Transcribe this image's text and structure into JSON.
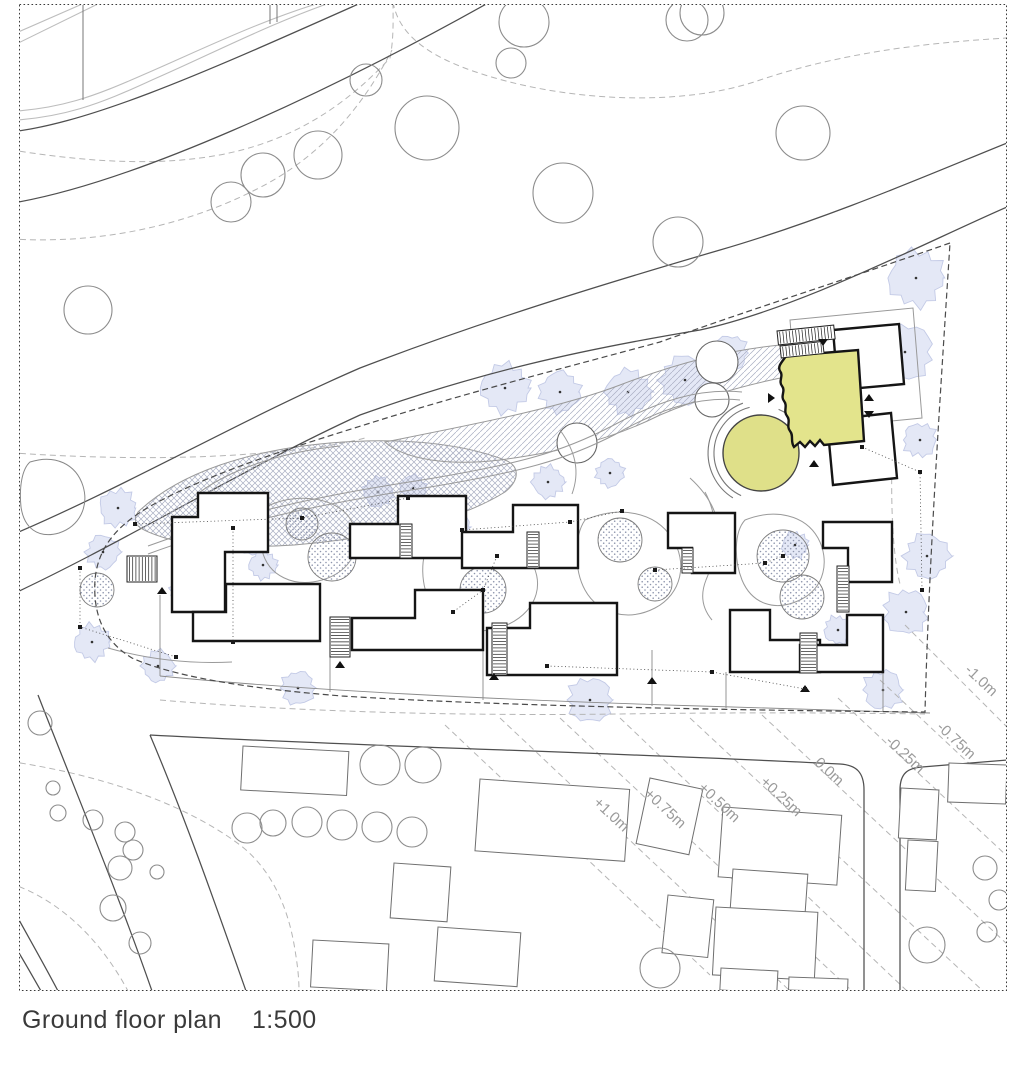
{
  "caption": {
    "title": "Ground floor plan",
    "scale": "1:500"
  },
  "colors": {
    "paper": "#ffffff",
    "line_dark": "#4f4f4f",
    "line_light": "#bdbdbd",
    "contour": "#b5b5b5",
    "boundary": "#4a4a4a",
    "path": "#9a9a9a",
    "building_stroke": "#151515",
    "neighbor_stroke": "#6f6f6f",
    "tree_stroke": "#8c8c8c",
    "canopy_fill": "#e4e8f6",
    "canopy_edge": "#c3cae6",
    "hatch_line": "#a9aec2",
    "dot_fill": "#8f96ad",
    "highlight_fill": "#e3e48c",
    "highlight_circle_fill": "#dfe089",
    "label_color": "#9a9a9a",
    "frame": "#3a3a3a"
  },
  "contour_labels": [
    {
      "text": "+1.0m",
      "x": 608,
      "y": 818,
      "rot": 43
    },
    {
      "text": "+0.75m",
      "x": 662,
      "y": 812,
      "rot": 43
    },
    {
      "text": "+0.50m",
      "x": 716,
      "y": 806,
      "rot": 43
    },
    {
      "text": "+0.25m",
      "x": 778,
      "y": 800,
      "rot": 43
    },
    {
      "text": "0.0m",
      "x": 826,
      "y": 775,
      "rot": 43
    },
    {
      "text": "-0.25m",
      "x": 902,
      "y": 758,
      "rot": 43
    },
    {
      "text": "-0.75m",
      "x": 953,
      "y": 744,
      "rot": 43
    },
    {
      "text": "-1.0m",
      "x": 978,
      "y": 684,
      "rot": 43
    }
  ],
  "roads": {
    "light": [
      "M0,112 C60,110 95,96 145,74 C205,48 265,18 336,-2",
      "M0,121 C62,119 100,104 152,80 C212,54 272,22 344,-2",
      "M0,40 L96,-2",
      "M0,52 L110,-2"
    ],
    "dark": [
      "M0,133 C85,127 210,70 372,-2",
      "M0,205 C125,188 330,92 497,-2",
      "M0,540 C120,490 240,420 360,368 C480,322 600,285 720,250 C830,218 935,172 1007,143",
      "M0,600 C120,545 240,470 360,415 C480,372 580,350 700,330 C800,308 920,245 1007,207",
      "M38,695 C75,790 116,888 152,991",
      "M150,735 C186,820 216,906 246,991",
      "M150,735 C350,746 600,752 840,764 C856,765 864,772 864,790 L864,991",
      "M900,991 L900,790 C900,773 908,768 922,767 L1007,760",
      "M8,900 C30,940 45,966 58,991",
      "M0,922 C18,950 30,972 41,991"
    ],
    "posts": [
      [
        83,
        2,
        83,
        100
      ],
      [
        270,
        2,
        270,
        24
      ],
      [
        277,
        2,
        277,
        22
      ]
    ]
  },
  "contours": {
    "wavy": [
      "M0,148 C70,160 140,166 200,158 C280,148 340,112 390,58 C394,38 393,18 393,0",
      "M0,238 C90,246 180,228 255,190 C320,158 362,108 392,50",
      "M393,2 C398,30 420,52 470,70 C560,102 680,108 760,80 C850,50 940,42 1007,38",
      "M0,452 C80,458 170,460 250,454 C300,450 335,446 365,438",
      "M0,760 C90,772 180,800 240,845 C270,868 288,905 295,950 C298,968 299,980 299,991",
      "M0,880 C50,894 95,930 128,991",
      "M160,700 C300,712 460,716 620,714 C760,712 850,713 925,714",
      "M893,428 C890,495 892,552 900,584"
    ],
    "diagonal": [
      [
        445,
        725,
        710,
        975
      ],
      [
        500,
        718,
        790,
        991
      ],
      [
        560,
        718,
        852,
        991
      ],
      [
        620,
        718,
        907,
        991
      ],
      [
        690,
        718,
        983,
        991
      ],
      [
        762,
        715,
        1007,
        944
      ],
      [
        838,
        698,
        1007,
        856
      ],
      [
        880,
        680,
        1007,
        799
      ],
      [
        905,
        625,
        1007,
        727
      ]
    ]
  },
  "boundary_d": "M950,243 C850,278 755,308 660,342 C575,365 470,392 380,420 C300,445 218,470 158,502 C120,522 98,545 95,580 C93,612 102,640 132,658 C172,676 242,688 342,696 C482,705 700,710 925,712 C929,560 940,400 950,243 Z",
  "pond_d": "M30,462 C55,454 76,464 83,486 C89,506 80,526 59,533 C38,539 24,528 21,507 C19,487 22,469 30,462 Z",
  "hatch": {
    "cross_d": "M138,512 C180,472 250,450 330,443 C400,437 460,443 505,460 C520,466 520,480 505,492 C460,520 400,532 340,540 C270,550 200,548 165,538 C140,530 130,525 138,512 Z",
    "single_d": "M385,442 C470,425 560,408 620,385 C680,362 730,350 780,345 C800,343 815,345 818,355 C820,365 810,372 790,376 C740,386 700,398 660,415 C610,440 560,452 500,460 C450,466 405,460 385,442 Z"
  },
  "paths_light": [
    "M148,546 C240,512 330,494 422,480 C520,464 562,452 612,426 C660,400 700,388 742,392",
    "M148,554 C240,520 332,502 424,488 C522,472 566,460 616,434 C662,408 700,396 740,400",
    "M270,505 C300,492 340,498 352,522 C364,548 350,572 322,580 C294,588 268,576 262,550 C258,528 260,515 270,505 Z",
    "M430,542 C468,527 508,532 528,557 C546,581 538,610 509,624 C478,638 446,630 432,606 C420,585 420,557 430,542 Z",
    "M585,520 C620,505 655,512 672,538 C688,562 682,594 655,608 C628,622 598,614 585,590 C574,570 574,536 585,520 Z",
    "M745,520 C775,508 805,515 818,538 C830,560 825,588 800,600 C775,612 752,604 742,580 C734,560 734,532 745,520 Z",
    "M690,478 C712,498 722,520 719,546",
    "M200,492 C230,470 280,452 340,446",
    "M108,648 C150,660 192,664 232,662",
    "M560,430 C576,452 580,472 572,494",
    "M705,492 C720,520 718,552 706,580 C700,595 702,608 712,620"
  ],
  "plaza_arcs": [
    {
      "cx": 761,
      "cy": 453,
      "r": 47,
      "a1": 115,
      "a2": 256
    },
    {
      "cx": 761,
      "cy": 453,
      "r": 53,
      "a1": 122,
      "a2": 250
    },
    {
      "cx": 761,
      "cy": 453,
      "r": 47,
      "a1": 292,
      "a2": 344
    }
  ],
  "planting": [
    [
      302,
      524,
      16
    ],
    [
      332,
      557,
      24
    ],
    [
      97,
      590,
      17
    ],
    [
      483,
      590,
      23
    ],
    [
      500,
      550,
      15
    ],
    [
      620,
      540,
      22
    ],
    [
      655,
      584,
      17
    ],
    [
      453,
      613,
      22
    ],
    [
      783,
      556,
      26
    ],
    [
      802,
      597,
      22
    ]
  ],
  "canopies": [
    [
      505,
      388,
      26
    ],
    [
      560,
      392,
      22
    ],
    [
      628,
      392,
      24
    ],
    [
      685,
      380,
      26
    ],
    [
      730,
      353,
      19
    ],
    [
      905,
      352,
      30
    ],
    [
      916,
      278,
      30
    ],
    [
      920,
      440,
      18
    ],
    [
      927,
      556,
      24
    ],
    [
      906,
      612,
      24
    ],
    [
      883,
      690,
      21
    ],
    [
      118,
      508,
      20
    ],
    [
      103,
      552,
      18
    ],
    [
      92,
      642,
      19
    ],
    [
      158,
      666,
      17
    ],
    [
      250,
      540,
      16
    ],
    [
      263,
      565,
      15
    ],
    [
      298,
      688,
      18
    ],
    [
      590,
      700,
      24
    ],
    [
      452,
      527,
      20
    ],
    [
      520,
      548,
      18
    ],
    [
      548,
      482,
      17
    ],
    [
      610,
      473,
      15
    ],
    [
      795,
      545,
      14
    ],
    [
      183,
      592,
      14
    ],
    [
      378,
      492,
      16
    ],
    [
      413,
      488,
      14
    ],
    [
      838,
      630,
      15
    ]
  ],
  "trees": [
    [
      366,
      80,
      16
    ],
    [
      427,
      128,
      32
    ],
    [
      524,
      22,
      25
    ],
    [
      511,
      63,
      15
    ],
    [
      563,
      193,
      30
    ],
    [
      318,
      155,
      24
    ],
    [
      231,
      202,
      20
    ],
    [
      263,
      175,
      22
    ],
    [
      687,
      20,
      21
    ],
    [
      678,
      242,
      25
    ],
    [
      702,
      13,
      22
    ],
    [
      803,
      133,
      27
    ],
    [
      88,
      310,
      24
    ],
    [
      40,
      723,
      12
    ],
    [
      53,
      788,
      7
    ],
    [
      58,
      813,
      8
    ],
    [
      93,
      820,
      10
    ],
    [
      125,
      832,
      10
    ],
    [
      133,
      850,
      10
    ],
    [
      120,
      868,
      12
    ],
    [
      157,
      872,
      7
    ],
    [
      113,
      908,
      13
    ],
    [
      140,
      943,
      11
    ],
    [
      247,
      828,
      15
    ],
    [
      273,
      823,
      13
    ],
    [
      307,
      822,
      15
    ],
    [
      342,
      825,
      15
    ],
    [
      377,
      827,
      15
    ],
    [
      412,
      832,
      15
    ],
    [
      380,
      765,
      20
    ],
    [
      423,
      765,
      18
    ],
    [
      927,
      945,
      18
    ],
    [
      985,
      868,
      12
    ],
    [
      999,
      900,
      10
    ],
    [
      660,
      968,
      20
    ],
    [
      987,
      932,
      10
    ]
  ],
  "trees_white": [
    [
      577,
      443,
      20
    ],
    [
      717,
      362,
      21
    ],
    [
      712,
      400,
      17
    ]
  ],
  "fences": [
    "M160,676 C300,690 500,700 700,706 L930,713",
    "M160,595 L160,676",
    "M330,640 L330,692",
    "M483,650 L483,700",
    "M652,650 L652,706",
    "M726,672 L726,708",
    "M883,672 L883,711"
  ],
  "neighbors": [
    [
      243,
      746,
      106,
      44,
      3
    ],
    [
      480,
      779,
      150,
      72,
      4
    ],
    [
      650,
      778,
      54,
      67,
      12
    ],
    [
      723,
      807,
      119,
      70,
      4
    ],
    [
      733,
      869,
      75,
      41,
      4
    ],
    [
      716,
      907,
      102,
      68,
      3
    ],
    [
      668,
      895,
      46,
      58,
      6
    ],
    [
      721,
      968,
      57,
      22,
      3
    ],
    [
      789,
      977,
      59,
      13,
      2
    ],
    [
      394,
      863,
      57,
      55,
      4
    ],
    [
      313,
      940,
      76,
      47,
      3
    ],
    [
      438,
      927,
      83,
      54,
      4
    ],
    [
      901,
      788,
      38,
      50,
      3
    ],
    [
      908,
      840,
      30,
      50,
      3
    ],
    [
      949,
      763,
      58,
      39,
      2
    ]
  ],
  "buildings": [
    [
      [
        198,
        493
      ],
      [
        268,
        493
      ],
      [
        268,
        552
      ],
      [
        225,
        552
      ],
      [
        225,
        612
      ],
      [
        172,
        612
      ],
      [
        172,
        517
      ],
      [
        198,
        517
      ]
    ],
    [
      [
        226,
        584
      ],
      [
        320,
        584
      ],
      [
        320,
        641
      ],
      [
        193,
        641
      ],
      [
        193,
        612
      ],
      [
        226,
        612
      ]
    ],
    [
      [
        398,
        496
      ],
      [
        466,
        496
      ],
      [
        466,
        558
      ],
      [
        350,
        558
      ],
      [
        350,
        524
      ],
      [
        398,
        524
      ]
    ],
    [
      [
        415,
        590
      ],
      [
        483,
        590
      ],
      [
        483,
        650
      ],
      [
        352,
        650
      ],
      [
        352,
        618
      ],
      [
        415,
        618
      ]
    ],
    [
      [
        513,
        505
      ],
      [
        578,
        505
      ],
      [
        578,
        568
      ],
      [
        462,
        568
      ],
      [
        462,
        532
      ],
      [
        513,
        532
      ]
    ],
    [
      [
        530,
        603
      ],
      [
        617,
        603
      ],
      [
        617,
        675
      ],
      [
        487,
        675
      ],
      [
        487,
        628
      ],
      [
        530,
        628
      ]
    ],
    [
      [
        668,
        513
      ],
      [
        735,
        513
      ],
      [
        735,
        573
      ],
      [
        692,
        573
      ],
      [
        692,
        548
      ],
      [
        668,
        548
      ]
    ],
    [
      [
        730,
        610
      ],
      [
        770,
        610
      ],
      [
        770,
        640
      ],
      [
        820,
        640
      ],
      [
        820,
        672
      ],
      [
        730,
        672
      ]
    ],
    [
      [
        823,
        522
      ],
      [
        892,
        522
      ],
      [
        892,
        582
      ],
      [
        848,
        582
      ],
      [
        848,
        548
      ],
      [
        823,
        548
      ]
    ],
    [
      [
        847,
        615
      ],
      [
        883,
        615
      ],
      [
        883,
        672
      ],
      [
        800,
        672
      ],
      [
        800,
        645
      ],
      [
        847,
        645
      ]
    ]
  ],
  "stairs": [
    [
      127,
      556,
      30,
      26,
      0
    ],
    [
      330,
      617,
      20,
      40,
      0
    ],
    [
      400,
      524,
      12,
      34,
      0
    ],
    [
      527,
      532,
      12,
      36,
      0
    ],
    [
      492,
      623,
      15,
      52,
      0
    ],
    [
      682,
      548,
      11,
      25,
      0
    ],
    [
      800,
      633,
      17,
      40,
      0
    ],
    [
      837,
      566,
      12,
      46,
      0
    ],
    [
      777,
      331,
      57,
      14,
      -6
    ],
    [
      780,
      346,
      43,
      12,
      -6
    ]
  ],
  "triangles": [
    [
      162,
      591,
      "up"
    ],
    [
      340,
      665,
      "up"
    ],
    [
      494,
      677,
      "up"
    ],
    [
      652,
      681,
      "up"
    ],
    [
      805,
      689,
      "up"
    ],
    [
      823,
      342,
      "down"
    ],
    [
      869,
      398,
      "up"
    ],
    [
      869,
      414,
      "down"
    ],
    [
      814,
      464,
      "up"
    ],
    [
      771,
      398,
      "right"
    ]
  ],
  "highlight": {
    "building_d": "M786,356 L858,350 L864,441 L824,445 L820,440 L815,446 L810,441 L805,447 L800,442 L794,447 C790,441 794,436 790,431 C786,426 791,421 787,416 C783,411 788,406 784,401 C780,396 786,391 782,386 C778,381 784,376 780,371 C777,366 783,361 786,356 Z",
    "circle": {
      "cx": 761,
      "cy": 453,
      "r": 38
    },
    "ne_pts": "833,330 899,324 904,384 838,390",
    "se_pts": "827,420 891,413 897,478 833,485",
    "back_pts": "790,320 913,308 922,418 799,430"
  },
  "dotted_nets": [
    [
      [
        135,
        524
      ],
      [
        302,
        518
      ],
      [
        408,
        498
      ]
    ],
    [
      [
        462,
        530
      ],
      [
        570,
        522
      ],
      [
        622,
        511
      ]
    ],
    [
      [
        655,
        570
      ],
      [
        765,
        563
      ],
      [
        783,
        556
      ]
    ],
    [
      [
        862,
        447
      ],
      [
        920,
        472
      ],
      [
        922,
        590
      ]
    ],
    [
      [
        80,
        568
      ],
      [
        80,
        627
      ],
      [
        176,
        657
      ]
    ],
    [
      [
        497,
        556
      ],
      [
        483,
        590
      ],
      [
        453,
        612
      ]
    ],
    [
      [
        547,
        666
      ],
      [
        712,
        672
      ],
      [
        805,
        689
      ]
    ],
    [
      [
        233,
        528
      ],
      [
        233,
        642
      ]
    ]
  ],
  "frame": {
    "x": 19.5,
    "y": 4.5,
    "w": 987,
    "h": 986
  }
}
